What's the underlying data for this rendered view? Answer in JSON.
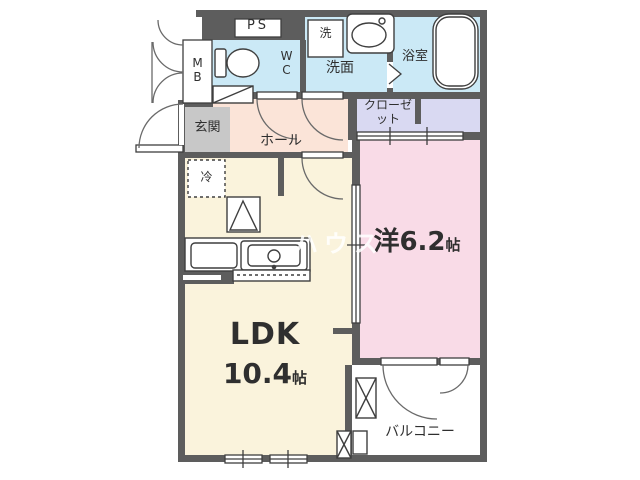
{
  "plan": {
    "rooms": {
      "ps": {
        "label": "PS"
      },
      "mb": {
        "label": "MB"
      },
      "wc": {
        "label": "WC"
      },
      "washer": {
        "label": "洗"
      },
      "washroom": {
        "label": "洗面"
      },
      "bathroom": {
        "label": "浴室"
      },
      "closet": {
        "label": "クローゼット"
      },
      "entrance": {
        "label": "玄関"
      },
      "hall": {
        "label": "ホール"
      },
      "fridge": {
        "label": "冷"
      },
      "ldk": {
        "name": "LDK",
        "size": "10.4",
        "unit": "帖"
      },
      "western_room": {
        "name": "洋6.2",
        "unit": "帖"
      },
      "balcony": {
        "label": "バルコニー"
      }
    },
    "watermark": "ハウス",
    "colors": {
      "wall": "#5d5d5d",
      "water_rooms": "#cbe9f6",
      "closet": "#d9d9f2",
      "hall": "#fbe4d8",
      "entrance_floor": "#c8c8c8",
      "ldk_floor": "#faf3dc",
      "western_room_floor": "#f9dbe7",
      "balcony_floor": "#ffffff",
      "line": "#3f3f3f"
    }
  }
}
